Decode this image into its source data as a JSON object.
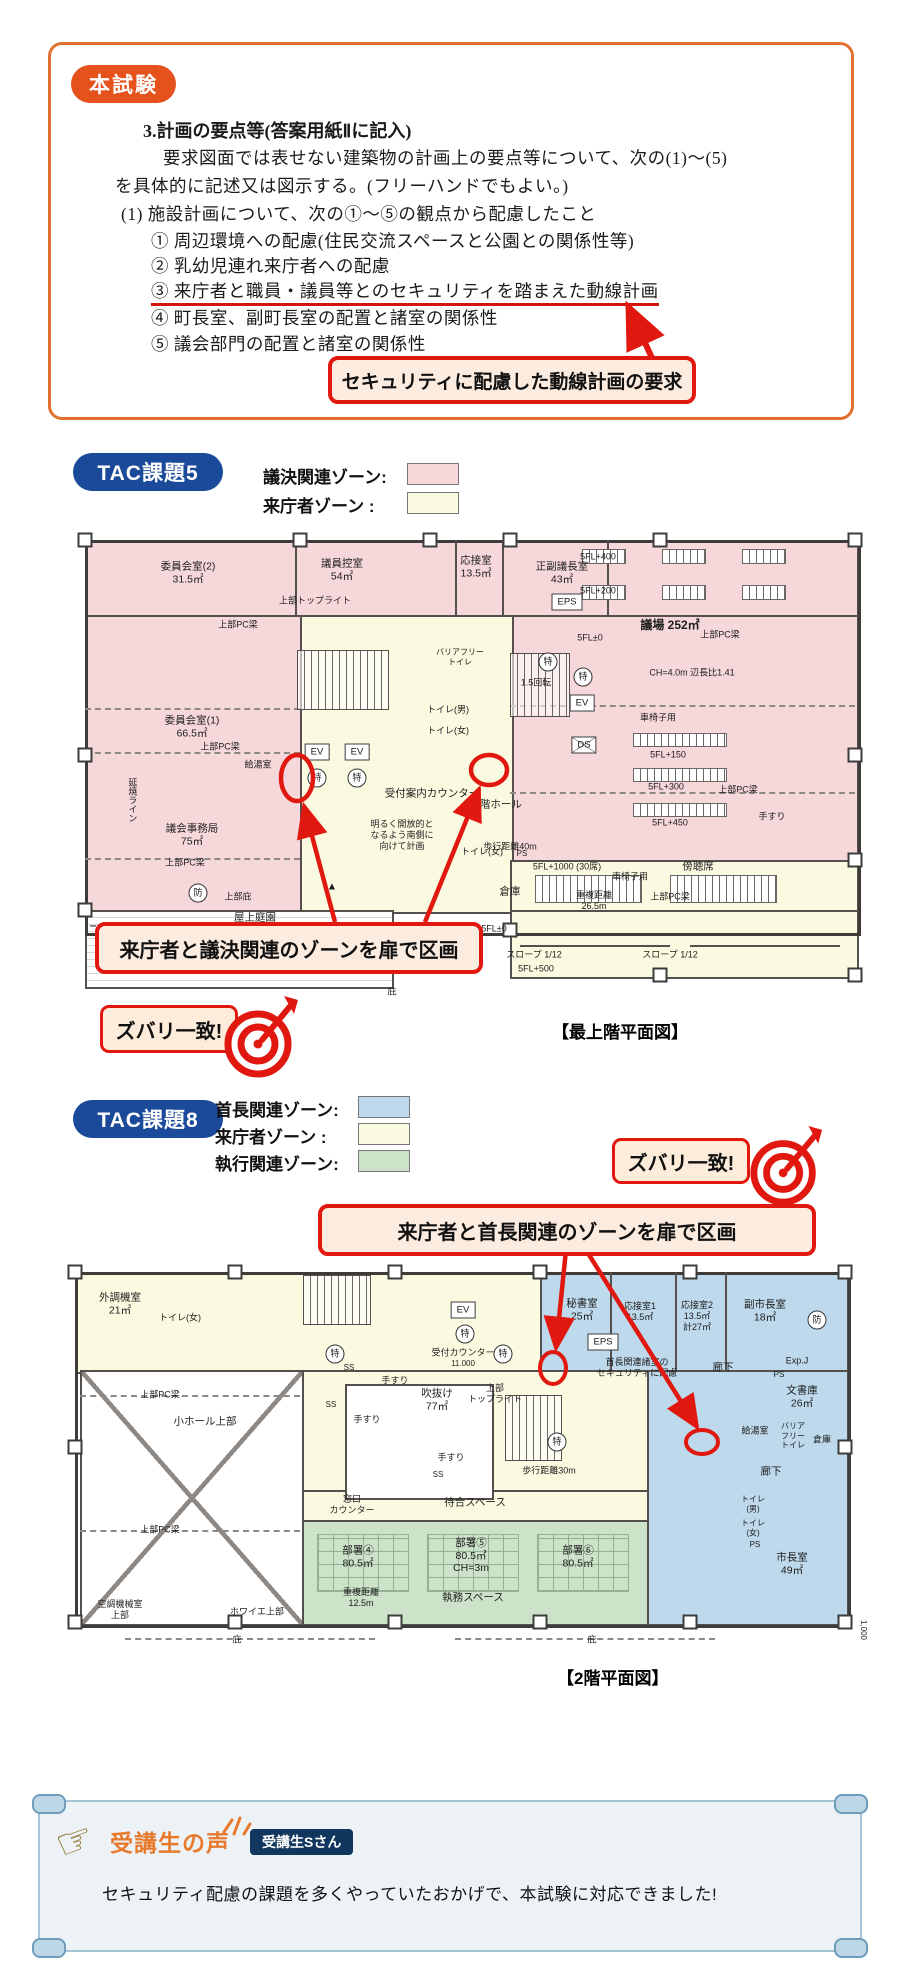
{
  "colors": {
    "accent_red": "#e0180f",
    "frame_orange": "#e0712e",
    "badge_orange": "#e5521c",
    "tac_blue": "#1b4a9b",
    "zone_pink": "#f6d7da",
    "zone_cream": "#fafae1",
    "zone_blue": "#bdd9eb",
    "zone_green": "#cde3c9",
    "voice_navy": "#12375e",
    "voice_orange": "#e87a2e"
  },
  "exam": {
    "badge": "本試験",
    "heading": "3.計画の要点等(答案用紙Ⅱに記入)",
    "line1": "要求図面では表せない建築物の計画上の要点等について、次の(1)〜(5)",
    "line2": "を具体的に記述又は図示する。(フリーハンドでもよい。)",
    "item1": "(1) 施設計画について、次の①〜⑤の観点から配慮したこと",
    "points": [
      "① 周辺環境への配慮(住民交流スペースと公園との関係性等)",
      "② 乳幼児連れ来庁者への配慮",
      "③ 来庁者と職員・議員等とのセキュリティを踏まえた動線計画",
      "④ 町長室、副町長室の配置と諸室の関係性",
      "⑤ 議会部門の配置と諸室の関係性"
    ],
    "callout": "セキュリティに配慮した動線計画の要求"
  },
  "task5": {
    "badge": "TAC課題5",
    "legend": [
      {
        "label": "議決関連ゾーン:"
      },
      {
        "label": "来庁者ゾーン :"
      }
    ],
    "annotation": "来庁者と議決関連のゾーンを扉で区画",
    "match": "ズバリ一致!",
    "caption": "【最上階平面図】",
    "labels": [
      "委員会室(2)\n31.5㎡",
      "議員控室\n54㎡",
      "応接室\n13.5㎡",
      "正副議長室\n43㎡",
      "EPS",
      "5FL+400",
      "5FL+200",
      "議場 252㎡",
      "5FL±0",
      "上部PC梁",
      "CH=4.0m 辺長比1.41",
      "車椅子用",
      "5FL+150",
      "5FL+300",
      "上部PC梁",
      "5FL+450",
      "手すり",
      "傍聴席",
      "上部トップライト",
      "上部PC梁",
      "委員会室(1)\n66.5㎡",
      "上部PC梁",
      "給湯室",
      "議会事務局\n75㎡",
      "延焼ライン",
      "EV",
      "EV",
      "特",
      "特",
      "受付案内カウンター",
      "明るく開放的と\nなるよう南側に\n向けて計画",
      "5階ホール",
      "歩行距離40m",
      "1.5回転",
      "EV",
      "DS",
      "バリアフリー\nトイレ",
      "トイレ(男)",
      "トイレ(女)",
      "特",
      "特",
      "トイレ(女)",
      "PS",
      "5FL+1000 (30席)",
      "倉庫",
      "重複距離\n26.5m",
      "車椅子用",
      "上部PC梁",
      "5FL±0",
      "スロープ 1/12",
      "スロープ 1/12",
      "5FL+500",
      "庇",
      "屋上庭園",
      "上部庇",
      "防",
      "上部PC梁",
      "▲"
    ]
  },
  "task8": {
    "badge": "TAC課題8",
    "legend": [
      {
        "label": "首長関連ゾーン:"
      },
      {
        "label": "来庁者ゾーン :"
      },
      {
        "label": "執行関連ゾーン:"
      }
    ],
    "annotation": "来庁者と首長関連のゾーンを扉で区画",
    "match": "ズバリ一致!",
    "caption": "【2階平面図】",
    "labels": [
      "外調機室\n21㎡",
      "トイレ(女)",
      "EV",
      "特",
      "受付カウンター",
      "11.000",
      "秘書室\n25㎡",
      "応接室1\n13.5㎡",
      "応接室2\n13.5㎡\n計27㎡",
      "副市長室\n18㎡",
      "防",
      "EPS",
      "首長関連諸室の\nセキュリティに配慮",
      "廊下",
      "Exp.J",
      "文書庫\n26㎡",
      "PS",
      "給湯室",
      "倉庫",
      "廊下",
      "トイレ\n(男)",
      "トイレ\n(女)",
      "PS",
      "市長室\n49㎡",
      "吹抜け\n77㎡",
      "上部\nトップライト",
      "手すり",
      "手すり",
      "手すり",
      "SS",
      "SS",
      "SS",
      "特",
      "特",
      "特",
      "歩行距離30m",
      "小ホール上部",
      "上部PC梁",
      "上部PC梁",
      "窓口\nカウンター",
      "待合スペース",
      "部署④\n80.5㎡",
      "部署⑤\n80.5㎡\nCH=3m",
      "部署⑥\n80.5㎡",
      "執務スペース",
      "重複距離\n12.5m",
      "空調機械室\n上部",
      "ホワイエ上部",
      "庇",
      "庇",
      "1,000",
      "バリア\nフリー\nトイレ"
    ]
  },
  "voice": {
    "title": "受講生の声",
    "badge": "受講生Sさん",
    "text": "セキュリティ配慮の課題を多くやっていたおかげで、本試験に対応できました!"
  }
}
